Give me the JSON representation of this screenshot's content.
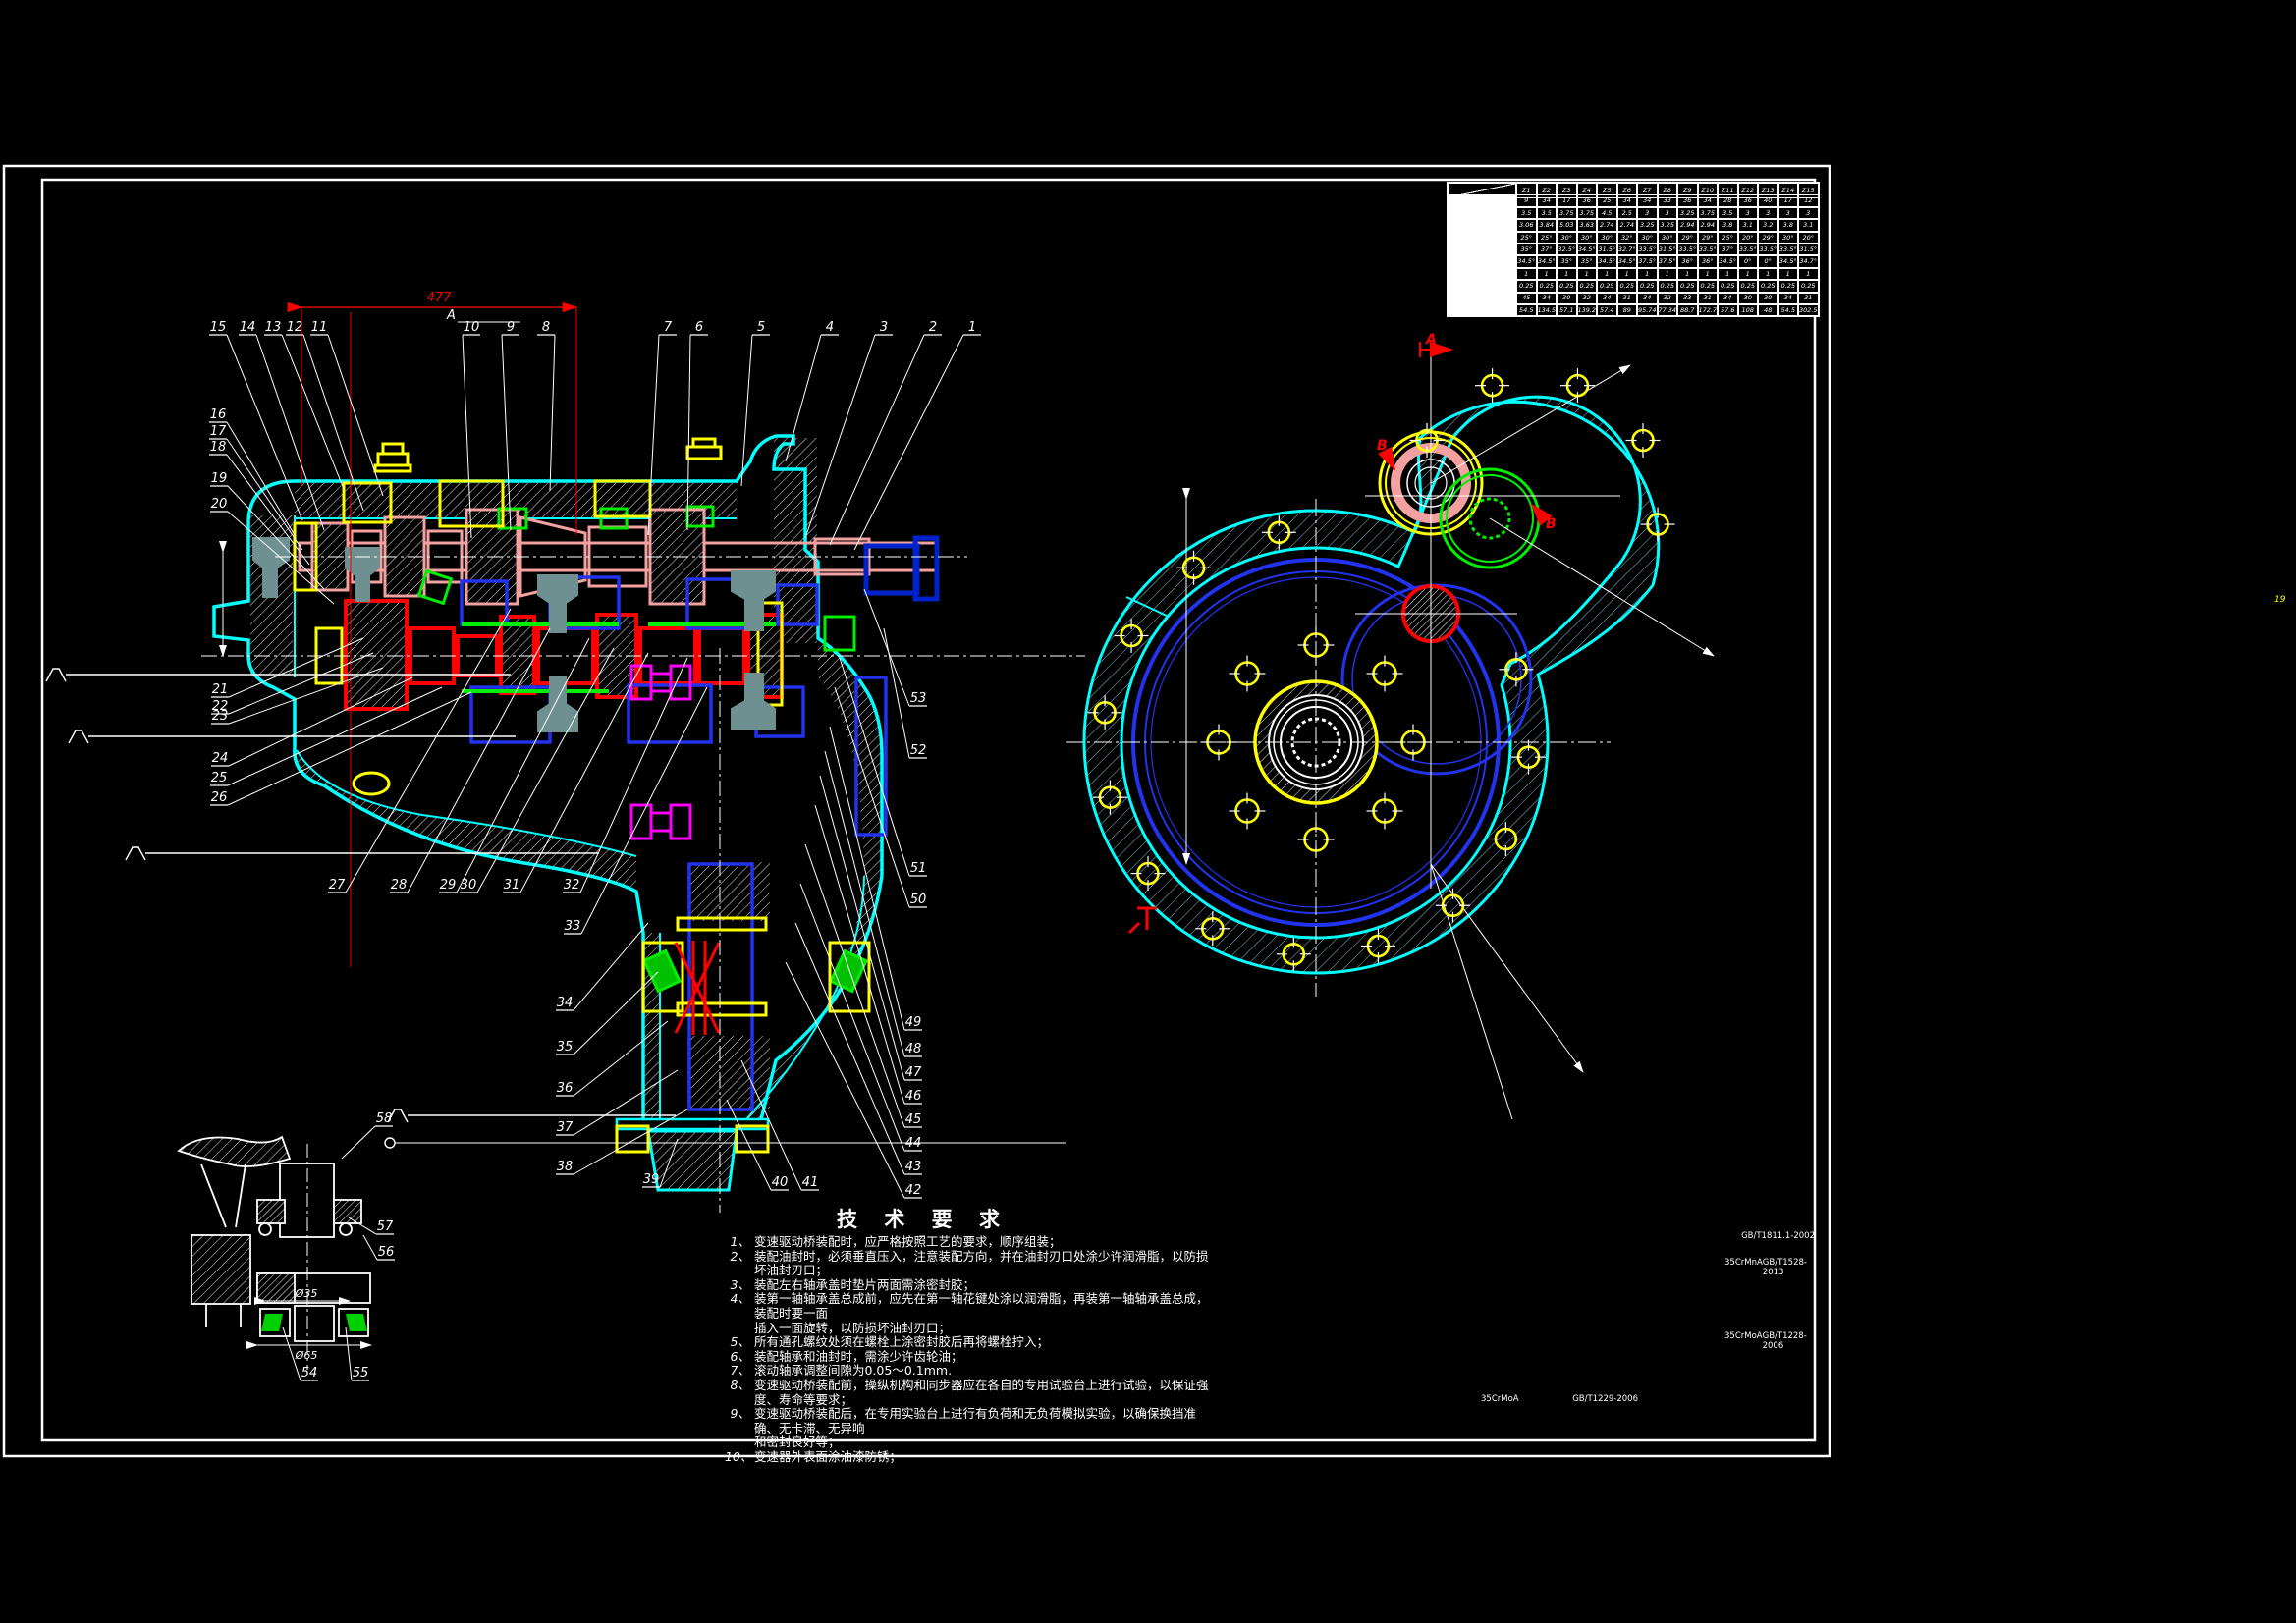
{
  "drawing": {
    "tech_title": "技 术 要 求",
    "tech_requirements": [
      {
        "n": "1、",
        "lines": [
          "变速驱动桥装配时，应严格按照工艺的要求，顺序组装；"
        ]
      },
      {
        "n": "2、",
        "lines": [
          "装配油封时，必须垂直压入，注意装配方向，并在油封刃口处涂少许润滑脂，以防损坏油封刃口；"
        ]
      },
      {
        "n": "3、",
        "lines": [
          "装配左右轴承盖时垫片两面需涂密封胶；"
        ]
      },
      {
        "n": "4、",
        "lines": [
          "装第一轴轴承盖总成前，应先在第一轴花键处涂以润滑脂，再装第一轴轴承盖总成，装配时要一面",
          "插入一面旋转，以防损坏油封刃口；"
        ]
      },
      {
        "n": "5、",
        "lines": [
          "所有通孔螺纹处须在螺栓上涂密封胶后再将螺栓拧入；"
        ]
      },
      {
        "n": "6、",
        "lines": [
          "装配轴承和油封时，需涂少许齿轮油；"
        ]
      },
      {
        "n": "7、",
        "lines": [
          "滚动轴承调整间隙为0.05～0.1mm."
        ]
      },
      {
        "n": "8、",
        "lines": [
          "变速驱动桥装配前，操纵机构和同步器应在各自的专用试验台上进行试验，以保证强度、寿命等要求；"
        ]
      },
      {
        "n": "9、",
        "lines": [
          "变速驱动桥装配后，在专用实验台上进行有负荷和无负荷模拟实验，以确保换挡准确、无卡滞、无异响",
          "和密封良好等；"
        ]
      },
      {
        "n": "10、",
        "lines": [
          "变速器外表面涂油漆防锈；"
        ]
      }
    ],
    "standards": [
      {
        "material": "",
        "code": "GB/T1811.1-2002"
      },
      {
        "material": "35CrMnA",
        "code": "GB/T1528-2013"
      },
      {
        "material": "35CrMoA",
        "code": "GB/T1228-2006"
      },
      {
        "material": "35CrMoA",
        "code": "GB/T1229-2006"
      }
    ],
    "gear_table": {
      "headers": [
        "Z1",
        "Z2",
        "Z3",
        "Z4",
        "Z5",
        "Z6",
        "Z7",
        "Z8",
        "Z9",
        "Z10",
        "Z11",
        "Z12",
        "Z13",
        "Z14",
        "Z15"
      ],
      "rows": [
        [
          "9",
          "34",
          "17",
          "36",
          "25",
          "34",
          "34",
          "33",
          "36",
          "34",
          "28",
          "36",
          "40",
          "17",
          "12"
        ],
        [
          "3.5",
          "3.5",
          "3.75",
          "3.75",
          "4.5",
          "2.5",
          "3",
          "3",
          "3.25",
          "3.75",
          "3.5",
          "3",
          "3",
          "3",
          "3"
        ],
        [
          "3.06",
          "3.84",
          "5.03",
          "3.63",
          "2.74",
          "2.74",
          "3.25",
          "3.25",
          "2.94",
          "2.94",
          "3.8",
          "3.1",
          "3.2",
          "3.8",
          "3.1"
        ],
        [
          "25°",
          "25°",
          "30°",
          "30°",
          "30°",
          "32°",
          "30°",
          "30°",
          "29°",
          "29°",
          "25°",
          "20°",
          "29°",
          "30°",
          "20°"
        ],
        [
          "35°",
          "37°",
          "32.5°",
          "34.5°",
          "31.5°",
          "32.7°",
          "33.5°",
          "31.5°",
          "33.5°",
          "33.5°",
          "37°",
          "33.5°",
          "33.5°",
          "33.5°",
          "31.5°"
        ],
        [
          "34.5°",
          "34.5°",
          "35°",
          "35°",
          "34.5°",
          "34.5°",
          "37.5°",
          "37.5°",
          "36°",
          "36°",
          "34.5°",
          "0°",
          "0°",
          "34.5°",
          "34.7°"
        ],
        [
          "1",
          "1",
          "1",
          "1",
          "1",
          "1",
          "1",
          "1",
          "1",
          "1",
          "1",
          "1",
          "1",
          "1",
          "1"
        ],
        [
          "0.25",
          "0.25",
          "0.25",
          "0.25",
          "0.25",
          "0.25",
          "0.25",
          "0.25",
          "0.25",
          "0.25",
          "0.25",
          "0.25",
          "0.25",
          "0.25",
          "0.25"
        ],
        [
          "45",
          "34",
          "30",
          "32",
          "34",
          "31",
          "34",
          "32",
          "33",
          "31",
          "34",
          "30",
          "30",
          "34",
          "31"
        ],
        [
          "54.5",
          "134.5",
          "57.1",
          "139.2",
          "57.4",
          "89",
          "95.74",
          "77.34",
          "88.7",
          "172.7",
          "57.6",
          "108",
          "48",
          "54.5",
          "302.5"
        ]
      ]
    },
    "callouts": [
      "1",
      "2",
      "3",
      "4",
      "5",
      "6",
      "7",
      "8",
      "9",
      "10",
      "11",
      "12",
      "13",
      "14",
      "15",
      "16",
      "17",
      "18",
      "19",
      "20",
      "21",
      "22",
      "23",
      "24",
      "25",
      "26",
      "27",
      "28",
      "29",
      "30",
      "31",
      "32",
      "33",
      "34",
      "35",
      "36",
      "37",
      "38",
      "39",
      "40",
      "41",
      "42",
      "43",
      "44",
      "45",
      "46",
      "47",
      "48",
      "49",
      "50",
      "51",
      "52",
      "53",
      "54",
      "55",
      "56",
      "57",
      "58"
    ],
    "dim_top": "477",
    "detail_dims": [
      "Ø35",
      "Ø65"
    ],
    "section_marks": {
      "a": "A",
      "b1": "B",
      "b2": "B",
      "a2": "A"
    },
    "corner_glyph": "19",
    "colors": {
      "housing": "#00ffff",
      "input_shaft": "#f2a0a0",
      "countershaft": "#ff0000",
      "gears_blue": "#2233ee",
      "gears_green": "#00ee00",
      "bearings_yellow": "#ffff00",
      "spider_magenta": "#ff00ff",
      "forks_gray": "#6e9090",
      "coupling_blue": "#0022cc",
      "lines_white": "#ffffff",
      "background": "#000000"
    }
  }
}
